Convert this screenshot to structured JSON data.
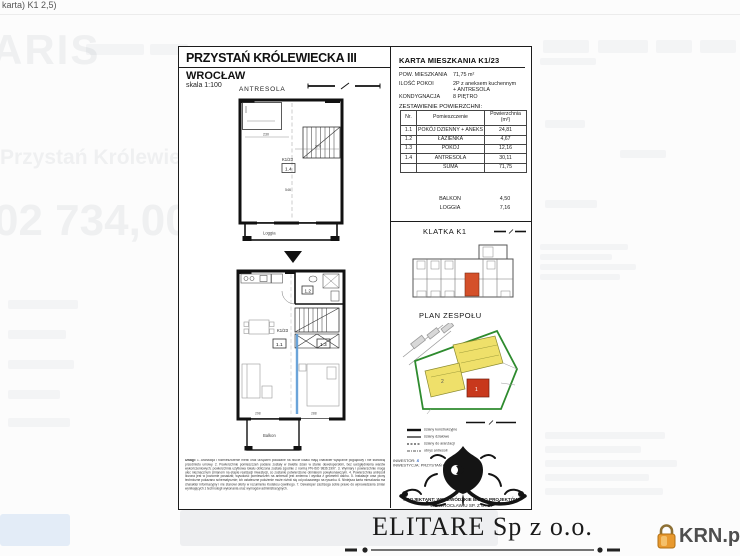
{
  "browser": {
    "tab_title_fragment": "karta) K1 2,5)"
  },
  "background_page": {
    "logo_fragment": "ARIS",
    "listing_title_fragment": "Przystań Królewieck:",
    "price_fragment": "02 734,00"
  },
  "document": {
    "header": {
      "title": "PRZYSTAŃ KRÓLEWIECKA III",
      "city": "WROCŁAW",
      "scale": "skala 1:100",
      "level_label": "ANTRESOLA"
    },
    "upper_plan": {
      "unit": "K1/23",
      "room": "1.4",
      "loggia": "Loggia",
      "dim1": "230",
      "dim2": "270",
      "dim3": "546"
    },
    "lower_plan": {
      "unit": "K1/23",
      "room_living": "1.1",
      "room_bath": "1.2",
      "room_bedroom": "1.3",
      "balcony": "Balkon",
      "dim1": "298",
      "dim2": "288"
    },
    "card": {
      "title": "KARTA MIESZKANIA K1/23",
      "fields": [
        {
          "label": "POW. MIESZKANIA",
          "value": "71,75 m²",
          "value2": ""
        },
        {
          "label": "ILOŚĆ POKOI",
          "value": "2P z aneksem kuchennym",
          "value2": "+ ANTRESOLA"
        },
        {
          "label": "KONDYGNACJA",
          "value": "8 PIĘTRO",
          "value2": ""
        }
      ],
      "table_caption": "ZESTAWIENIE POWIERZCHNI:",
      "table": {
        "headers": [
          "Nr.",
          "Pomieszczenie",
          "Powierzchnia (m²)"
        ],
        "rows": [
          [
            "1.1",
            "POKÓJ DZIENNY + ANEKS",
            "24,81"
          ],
          [
            "1.2",
            "ŁAZIENKA",
            "4,67"
          ],
          [
            "1.3",
            "POKÓJ",
            "12,16"
          ],
          [
            "1.4",
            "ANTRESOLA",
            "30,11"
          ],
          [
            "",
            "SUMA",
            "71,75"
          ]
        ]
      },
      "extras": [
        {
          "label": "BALKON",
          "value": "4,50"
        },
        {
          "label": "LOGGIA",
          "value": "7,16"
        }
      ]
    },
    "sections": {
      "klatka": "KLATKA K1",
      "plan_zespolu": "PLAN ZESPOŁU"
    },
    "legend": [
      "ściany konstrukcyjne",
      "ściany działowe",
      "ściany do aranżacji",
      "obrys antresoli"
    ],
    "notes": {
      "heading": "Uwagi:",
      "body": "1. Aranżacja i rozmieszczenie mebli oraz urządzeń pokazane na rzucie lokalu mają charakter wyłącznie poglądowy i nie stanowią przedmiotu umowy. 2. Powierzchnie pomieszczeń podane zostały w świetle ścian w stanie deweloperskim, bez uwzględnienia warstw wykończeniowych; powierzchnia użytkowa lokalu obliczona została zgodnie z normą PN-ISO 9836:1997. 3. Wymiary i powierzchnie mogą ulec nieznacznym zmianom na etapie realizacji inwestycji, co zostanie potwierdzone obmiarem powykonawczym. 4. Powierzchnia antresoli liczona jest w poziomie posadzki; wysokość pomieszczeń na antresoli jest zmienna i wynika z geometrii dachu. 5. Instalacje oraz piony techniczne pokazano schematycznie; ich ostateczne położenie może różnić się od pokazanego na rysunku. 6. Niniejsza karta mieszkania ma charakter informacyjny i nie stanowi oferty w rozumieniu Kodeksu cywilnego. 7. Deweloper zastrzega sobie prawo do wprowadzania zmian wynikających z technologii wykonania oraz wymogów administracyjnych."
    },
    "footer": {
      "inwestor": "INWESTOR:",
      "inwestycja": "INWESTYCJA: PRZYSTAŃ KRÓLEWIECKA",
      "projektant_line1": "PROJEKTANT: WOJEWÓDZKIE BIURO PROJEKTÓW",
      "projektant_line2": "WE WROCŁAWIU SP. Z O. O."
    }
  },
  "branding": {
    "company": "ELITARE Sp z o.o.",
    "watermark": "KRN.pl"
  },
  "colors": {
    "accent_unit": "#d4502a",
    "site_building_yellow": "#efe06a",
    "site_building_red": "#c8381c",
    "site_boundary_green": "#2e8b2e",
    "plan_highlight_blue": "#5b9bd5",
    "krn_orange": "#e8992e"
  }
}
